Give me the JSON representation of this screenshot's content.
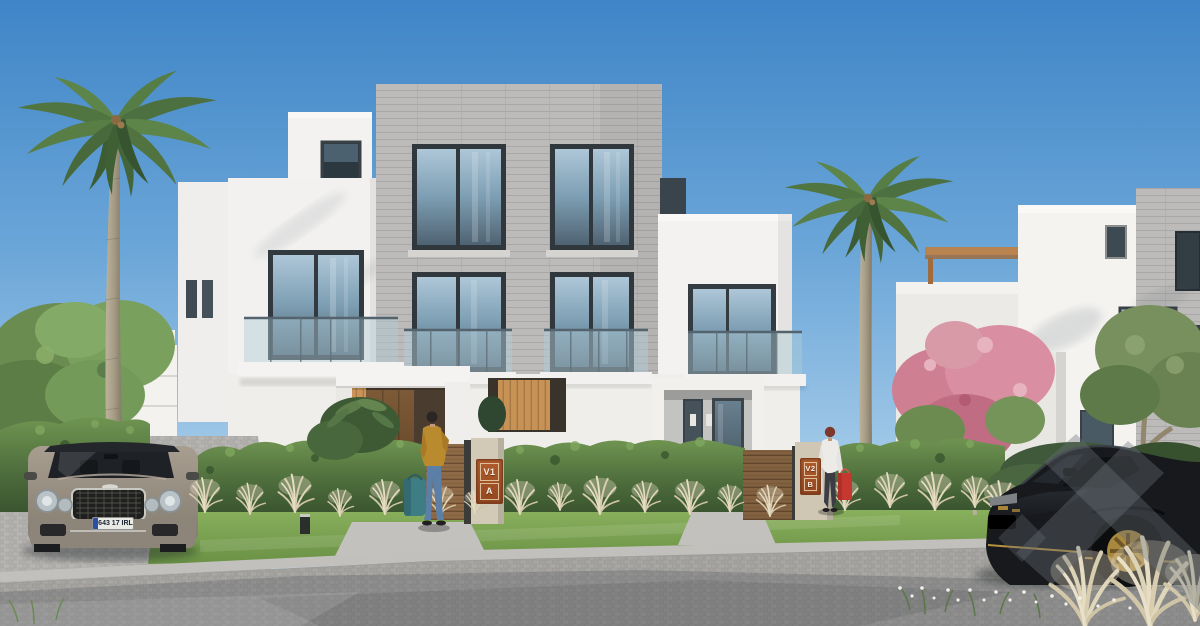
{
  "scene": {
    "title": "Residential villas exterior rendering",
    "description": "Sunny 3D architectural rendering of modern white duplex villas with a grey brick feature tower, glass balconies, landscaped hedges, palm trees, a silver luxury sedan and a black sports car on a cobbled street",
    "signs": {
      "gate_a": {
        "line1": "V1",
        "line2": "A"
      },
      "gate_b": {
        "line1": "V2",
        "line2": "B"
      }
    },
    "license_plate": {
      "text": "643 17 IRL"
    },
    "colors": {
      "sky_top": "#3f85c7",
      "sky_horizon": "#cfe4f3",
      "wall_white": "#f2f1ee",
      "brick_gray": "#bcbbb9",
      "glass_blue": "#7d9eb3",
      "frame_dark": "#343b41",
      "wood_brown": "#8e6a46",
      "door_brown": "#6b4a2c",
      "plaque_rust": "#a85427",
      "hedge_green": "#55743f",
      "lawn_green": "#7aa352",
      "grass_plume": "#e0d6ba",
      "pavement_grey": "#a3a19e",
      "curb_grey": "#c2c0bc",
      "car_silver": "#9b9285",
      "car_black": "#17191d",
      "wheel_gold": "#a8873f",
      "bag_teal": "#3f7d85",
      "bag_red": "#c4382f",
      "jacket_mustard": "#b98a2e",
      "blossom_pink": "#d98fa1"
    },
    "objects": [
      "duplex villa",
      "brick feature tower",
      "glass balconies",
      "entrance gates",
      "garden hedge",
      "ornamental grasses",
      "palm trees",
      "pink flowering tree",
      "luxury sedan",
      "black sports car",
      "pedestrian with duffel bag",
      "pedestrian with shopping bags",
      "cobblestone street",
      "rooftop pergola"
    ],
    "watermark": {
      "style": "translucent diagonal bars",
      "color": "#6a7076"
    }
  }
}
